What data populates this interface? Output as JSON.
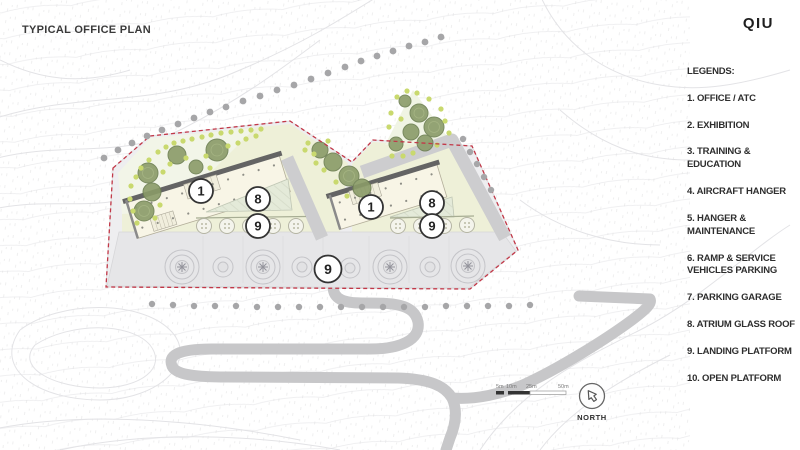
{
  "header": {
    "title": "TYPICAL OFFICE PLAN",
    "logo": "QIU"
  },
  "legend": {
    "heading": "LEGENDS:",
    "items": [
      "1. OFFICE / ATC",
      "2. EXHIBITION",
      "3. TRAINING & EDUCATION",
      "4. AIRCRAFT HANGER",
      "5. HANGER & MAINTENANCE",
      "6. RAMP & SERVICE VEHICLES PARKING",
      "7. PARKING GARAGE",
      "8. ATRIUM GLASS ROOF",
      "9. LANDING PLATFORM",
      "10. OPEN PLATFORM"
    ]
  },
  "plan": {
    "circles": [
      {
        "name": "left-office",
        "value": "1"
      },
      {
        "name": "left-atrium",
        "value": "8"
      },
      {
        "name": "left-landing",
        "value": "9"
      },
      {
        "name": "right-office",
        "value": "1"
      },
      {
        "name": "right-atrium",
        "value": "8"
      },
      {
        "name": "right-landing",
        "value": "9"
      },
      {
        "name": "apron-landing",
        "value": "9"
      }
    ]
  },
  "scalebar": {
    "ticks": [
      "5m",
      "10m",
      "25m",
      "50m"
    ]
  },
  "north": {
    "label": "NORTH",
    "icon": "north-arrow"
  },
  "colors": {
    "boundary": "#c23848",
    "lawn": "#eef0d8",
    "building": "#f8f5e6",
    "tree": "#84955f",
    "apron": "#e7e7e9",
    "road": "#c9c9cb",
    "text": "#2e2e2e"
  }
}
